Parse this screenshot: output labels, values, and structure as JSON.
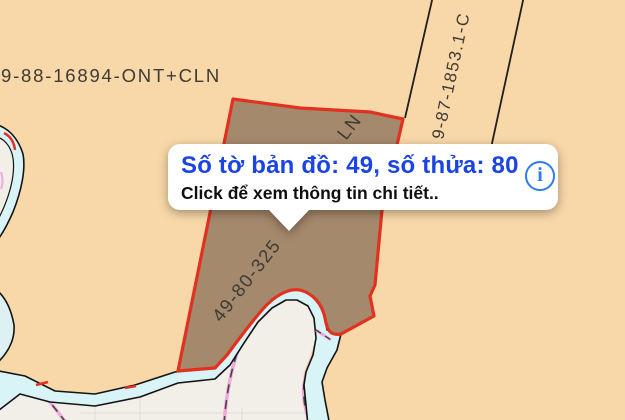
{
  "app": {
    "type": "cadastral-map-viewer"
  },
  "tooltip": {
    "title": "Số tờ bản đồ: 49, số thửa: 80",
    "subtitle": "Click để xem thông tin chi tiết..",
    "sheet_number": "49",
    "parcel_number": "80",
    "info_icon_glyph": "i",
    "title_color": "#1b44e4",
    "icon_color": "#2e7bf5"
  },
  "map": {
    "background_color": "#f8d8a8",
    "labels": {
      "parcel_top_left": "9-88-16894-ONT+CLN",
      "road_strip": "9-87-1853.1-C"
    },
    "selected_parcel": {
      "label_lower": "49-80-325",
      "label_upper": "LN",
      "fill_color": "#a5896c",
      "border_color": "#e23120"
    },
    "water_color": "#d9f4f7",
    "water_outline_color": "#141414",
    "white_area_color": "#f1efe8",
    "pink_boundary_color": "#f2aadc",
    "label_color": "#3e3a35"
  }
}
